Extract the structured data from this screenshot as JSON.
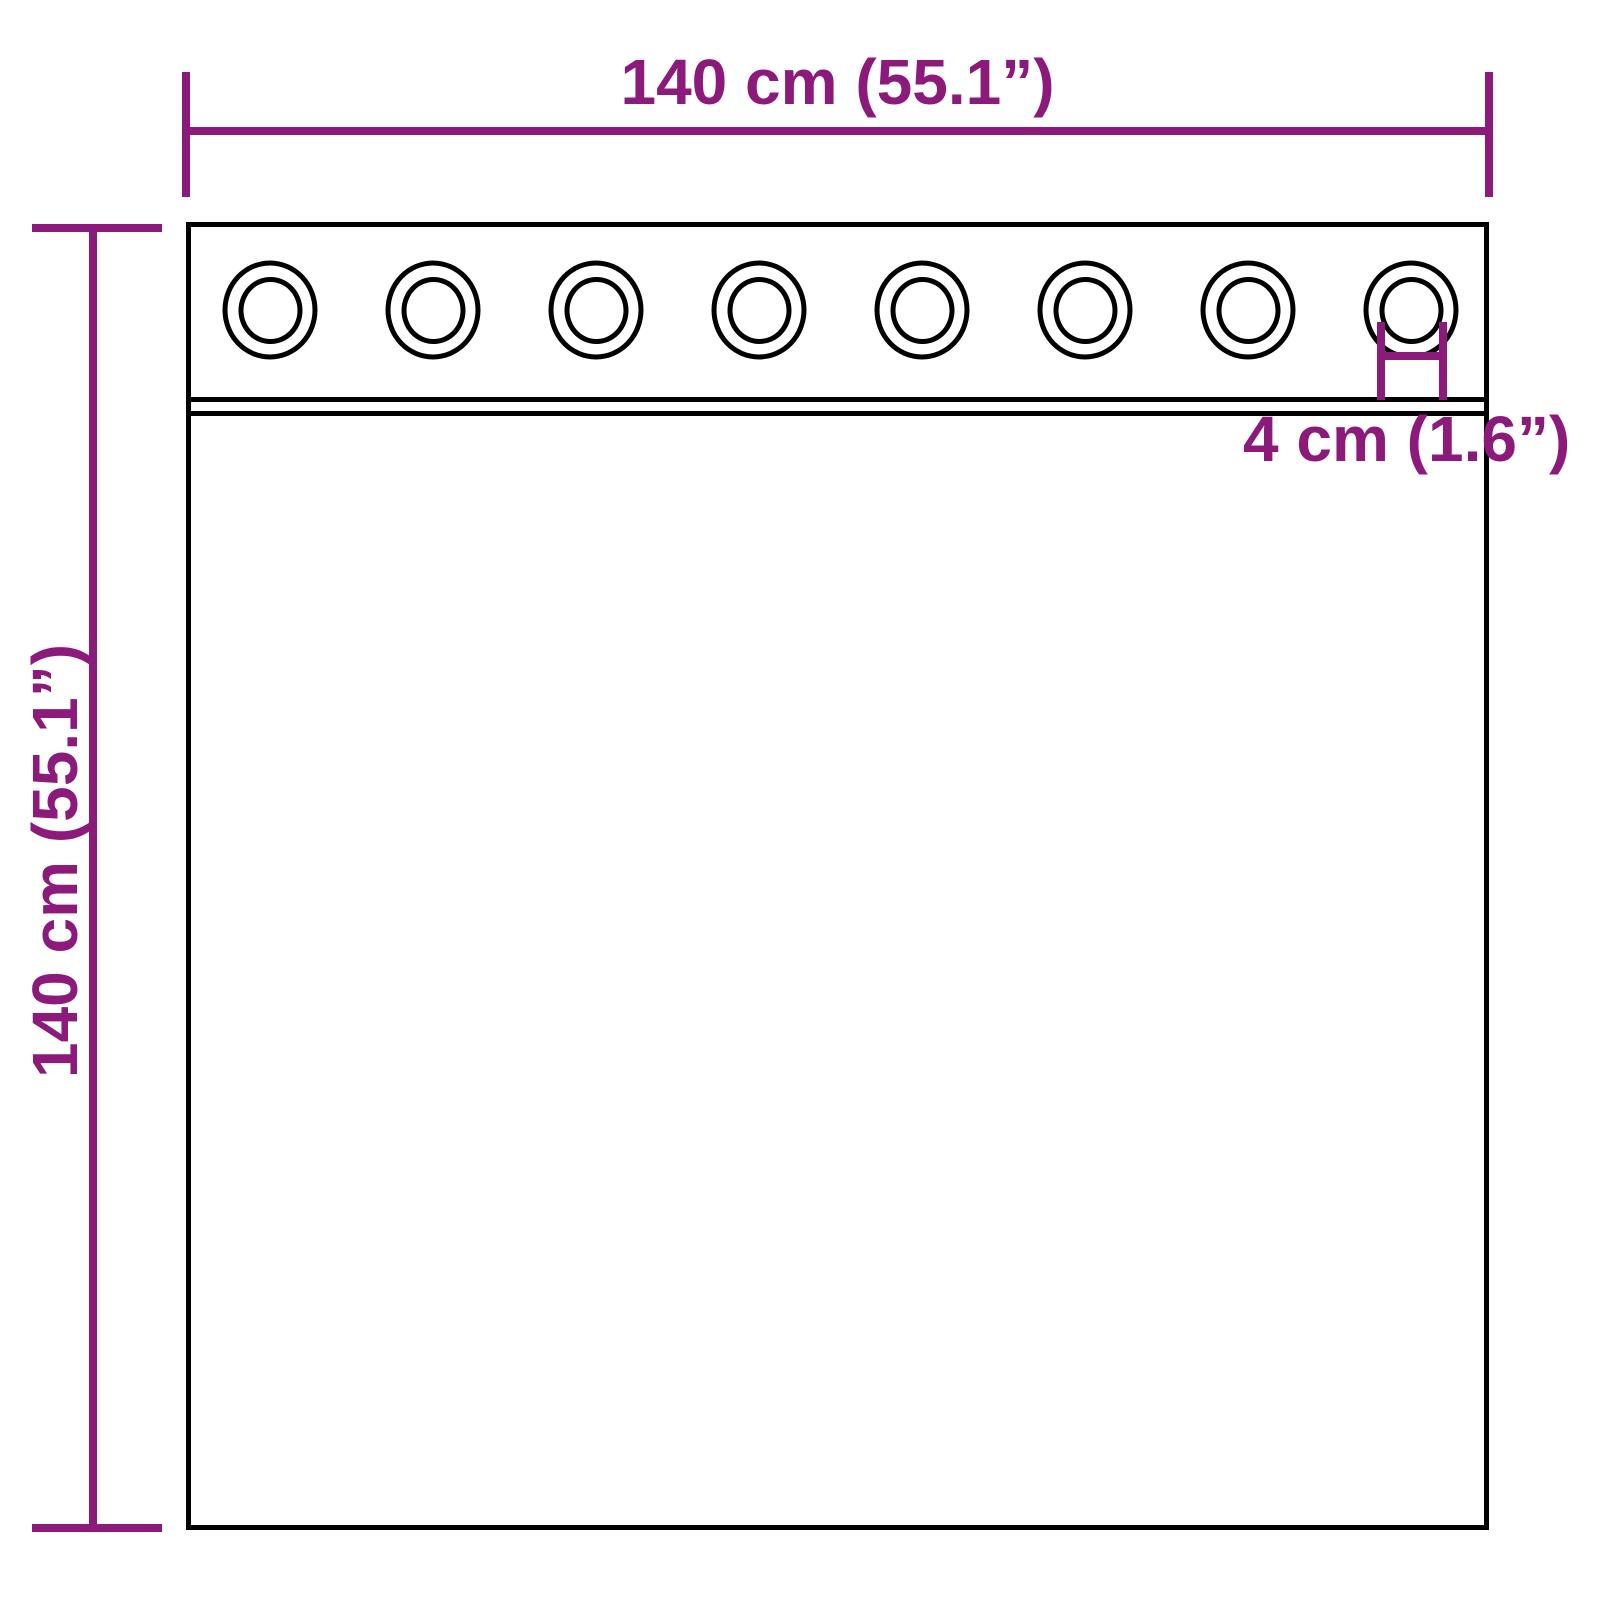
{
  "diagram": {
    "type": "product-dimension-diagram",
    "subject": "grommet-curtain",
    "colors": {
      "dimension_accent": "#8c1a7b",
      "outline": "#000000",
      "background": "#ffffff"
    },
    "measurements": {
      "width": {
        "value_cm": "140",
        "value_in": "55.1",
        "label": "140 cm (55.1”)"
      },
      "height": {
        "value_cm": "140",
        "value_in": "55.1",
        "label": "140 cm (55.1”)"
      },
      "grommet_diameter": {
        "value_cm": "4",
        "value_in": "1.6",
        "label": "4 cm (1.6”)"
      }
    },
    "grommets": {
      "count": 8
    }
  }
}
